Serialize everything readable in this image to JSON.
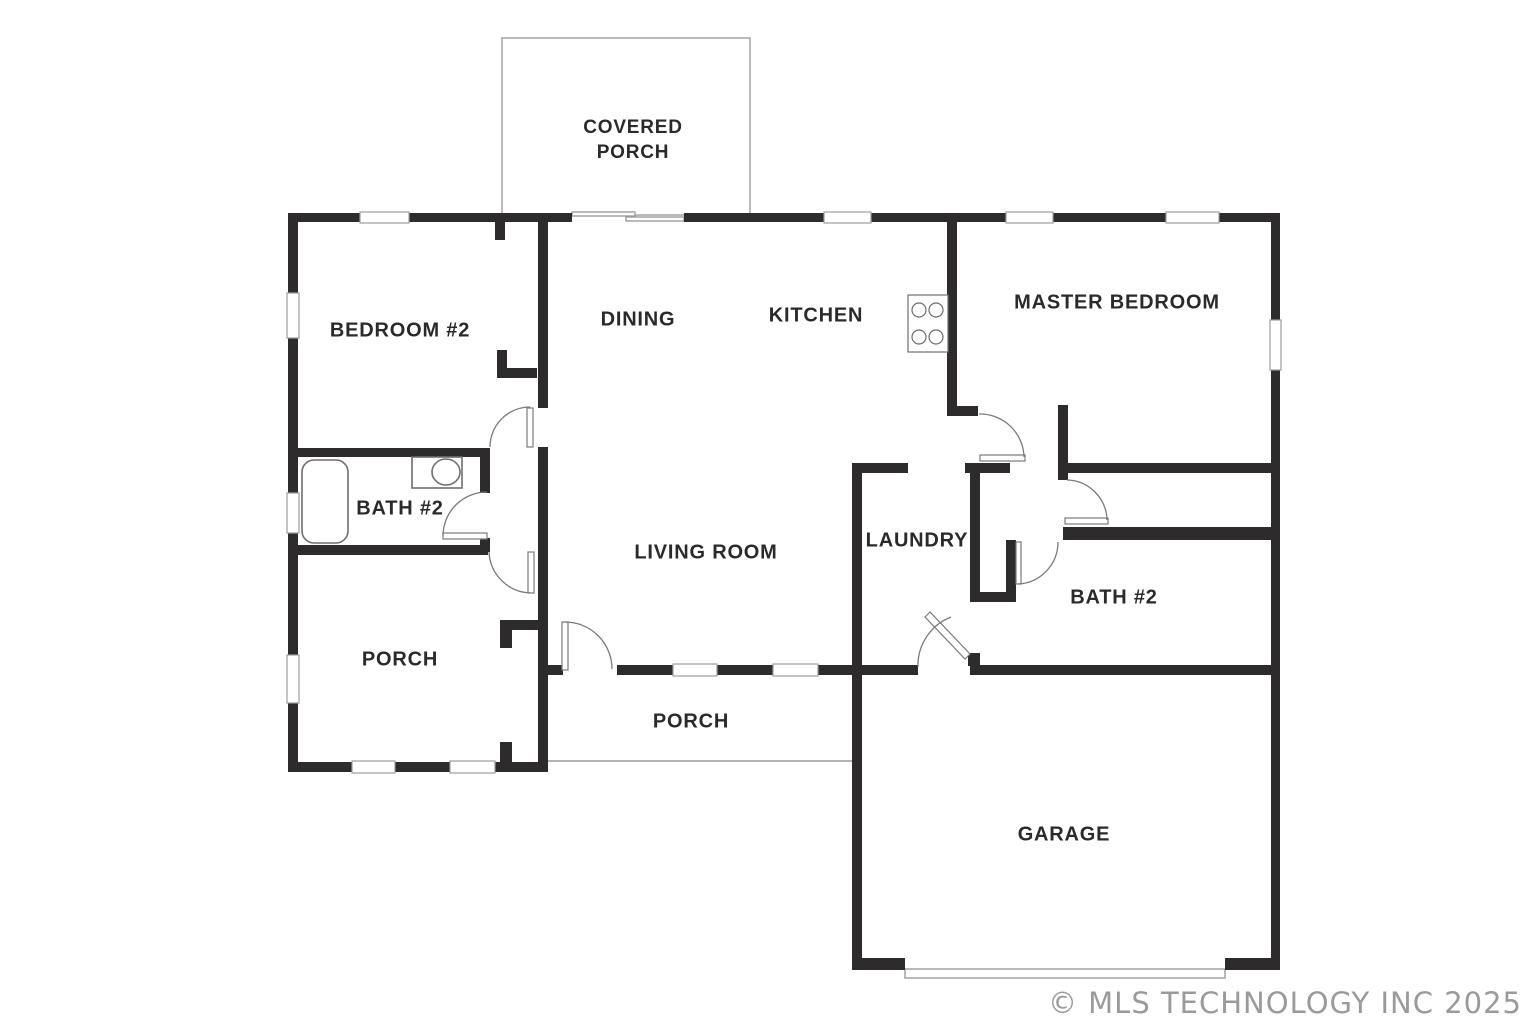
{
  "rooms": {
    "covered_porch_line1": "COVERED",
    "covered_porch_line2": "PORCH",
    "bedroom2": "BEDROOM #2",
    "dining": "DINING",
    "kitchen": "KITCHEN",
    "master_bedroom": "MASTER BEDROOM",
    "bath2_left": "BATH #2",
    "living_room": "LIVING ROOM",
    "laundry": "LAUNDRY",
    "bath2_right": "BATH #2",
    "porch_left": "PORCH",
    "porch_front": "PORCH",
    "garage": "GARAGE"
  },
  "watermark": "© MLS TECHNOLOGY INC 2025",
  "colors": {
    "background": "#ffffff",
    "wall": "#2d2b2c",
    "thin_line": "#9c9c9c",
    "label": "#2b2a2b",
    "watermark": "#9a9a9a"
  }
}
